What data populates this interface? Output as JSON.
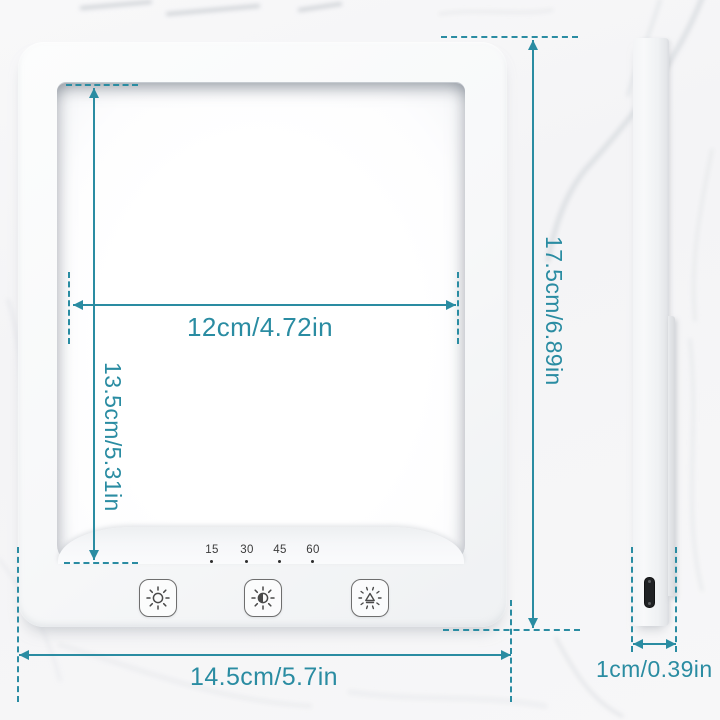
{
  "title": "Light therapy lamp dimensions diagram",
  "colors": {
    "accent": "#2a8ca2"
  },
  "front_view": {
    "timer_marks": [
      "15",
      "30",
      "45",
      "60"
    ],
    "buttons": [
      {
        "name": "power-button",
        "icon": "sun-ring-icon"
      },
      {
        "name": "brightness-button",
        "icon": "sun-half-icon"
      },
      {
        "name": "timer-button",
        "icon": "timer-dial-icon"
      }
    ]
  },
  "dimensions": {
    "panel_width": "12cm/4.72in",
    "panel_height": "13.5cm/5.31in",
    "device_height": "17.5cm/6.89in",
    "device_width": "14.5cm/5.7in",
    "device_depth": "1cm/0.39in"
  }
}
